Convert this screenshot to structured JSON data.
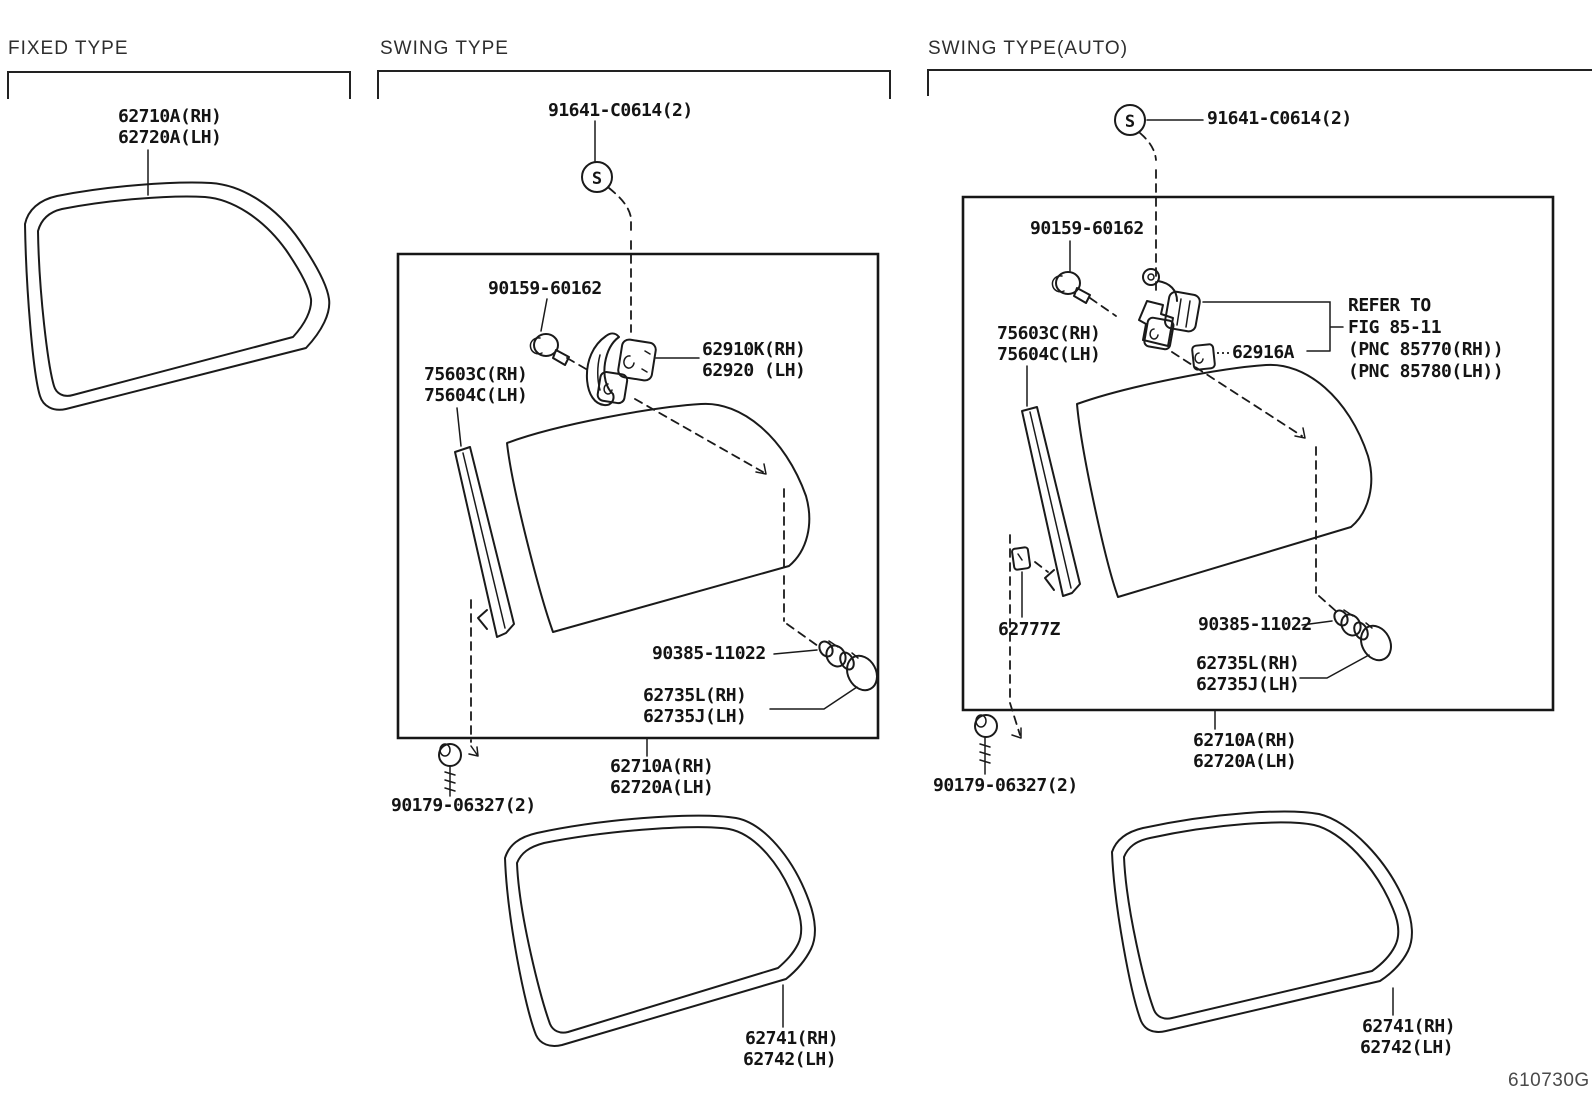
{
  "footer": {
    "code": "610730G"
  },
  "symbols": {
    "s": "S"
  },
  "sections": {
    "fixed": {
      "title": "FIXED TYPE",
      "weatherstrip_rh": "62710A(RH)",
      "weatherstrip_lh": "62720A(LH)"
    },
    "swing": {
      "title": "SWING TYPE",
      "set_screw": "91641-C0614(2)",
      "bolt": "90159-60162",
      "hinge_rh": "62910K(RH)",
      "hinge_lh": "62920 (LH)",
      "garnish_rh": "75603C(RH)",
      "garnish_lh": "75604C(LH)",
      "grommet": "90385-11022",
      "plug_rh": "62735L(RH)",
      "plug_lh": "62735J(LH)",
      "weatherstrip_rh": "62710A(RH)",
      "weatherstrip_lh": "62720A(LH)",
      "screw": "90179-06327(2)",
      "seal_rh": "62741(RH)",
      "seal_lh": "62742(LH)"
    },
    "swing_auto": {
      "title": "SWING TYPE(AUTO)",
      "set_screw": "91641-C0614(2)",
      "bolt": "90159-60162",
      "refer_1": "REFER TO",
      "refer_2": "FIG 85-11",
      "refer_3": "(PNC 85770(RH))",
      "refer_4": "(PNC 85780(LH))",
      "lock": "62916A",
      "garnish_rh": "75603C(RH)",
      "garnish_lh": "75604C(LH)",
      "clip": "62777Z",
      "grommet": "90385-11022",
      "plug_rh": "62735L(RH)",
      "plug_lh": "62735J(LH)",
      "weatherstrip_rh": "62710A(RH)",
      "weatherstrip_lh": "62720A(LH)",
      "screw": "90179-06327(2)",
      "seal_rh": "62741(RH)",
      "seal_lh": "62742(LH)"
    }
  }
}
